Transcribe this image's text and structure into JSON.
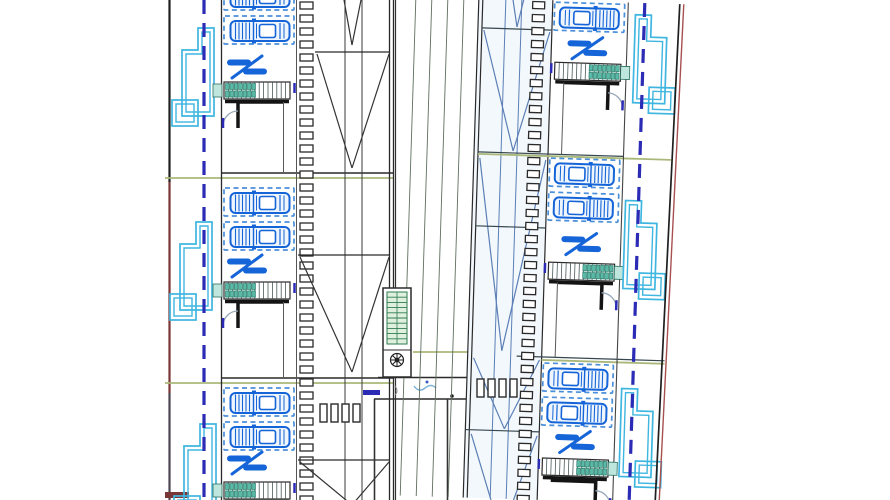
{
  "title": "Residential site plan CAD drawing",
  "colors": {
    "paper": "#ffffff",
    "car_blue": "#1565d8",
    "car_fill": "#eef5fd",
    "stall_blue": "#4a8fd9",
    "cyan": "#3fb6e0",
    "dash_blue": "#2b2bb5",
    "olive": "#a9b87a",
    "maroon": "#7a3636",
    "gray_boundary": "#4b4552",
    "black": "#1f1f1f",
    "wall_dark": "#141414",
    "line_dark": "#2a2a2a",
    "line_mid": "#555555",
    "teal": "#57b9a6",
    "teal_fill": "#bfe6dd",
    "teal_edge": "#2b6e5f",
    "road_line": "#5f6f5f",
    "steel_blue": "#5b7fb5",
    "light_blue_fill": "#f3f8fd",
    "red_line": "#a85050",
    "arc_gray": "#98a8b8",
    "shaft_green": "#2e7d4f",
    "shaft_fill": "#dff0df",
    "squiggle": "#7fb3d8"
  },
  "geometry": {
    "canvas": {
      "w": 890,
      "h": 500
    },
    "left_strip": {
      "boundary_x": 169.5,
      "boundary_segments": [
        {
          "y1": 0,
          "y2": 182,
          "color_key": "black"
        },
        {
          "y1": 182,
          "y2": 393,
          "color_key": "maroon"
        },
        {
          "y1": 393,
          "y2": 500,
          "color_key": "gray_boundary"
        }
      ],
      "bottom_mark": {
        "x": 165,
        "y": 492,
        "w": 24,
        "h": 6
      },
      "dashed_x": 204,
      "pools": [
        {
          "tx": 172,
          "ty": 28
        },
        {
          "tx": 170,
          "ty": 222
        },
        {
          "tx": 174,
          "ty": 424
        }
      ]
    },
    "dividers": {
      "olive": [
        [
          165,
          178,
          393,
          178
        ],
        [
          165,
          383,
          393,
          383
        ]
      ],
      "dark": [
        [
          221,
          173,
          393,
          173
        ],
        [
          221,
          378,
          393,
          378
        ]
      ]
    },
    "left_units": {
      "wall_x": 221.5,
      "edge_x": 296.5,
      "stall": {
        "x": 224,
        "w": 70,
        "h": 28
      },
      "car_dx": 3.5,
      "car_dy": 3,
      "gate_x": 247,
      "stair_x": 224,
      "rows": [
        {
          "stalls": [
            -18,
            16
          ],
          "gate": 67,
          "stair": 82,
          "wall": 102,
          "divider": 173
        },
        {
          "stalls": [
            188,
            222
          ],
          "gate": 266,
          "stair": 282,
          "wall": 302,
          "divider": 378
        },
        {
          "stalls": [
            388,
            422
          ],
          "gate": 463,
          "stair": 482,
          "wall": null,
          "divider": null
        }
      ]
    },
    "left_building": {
      "hatch": {
        "x": 300,
        "w": 13,
        "h": 7,
        "y0": 2,
        "step": 13,
        "count": 39
      },
      "verticals": [
        345,
        362
      ],
      "edge_x": [
        389.5,
        393.5
      ],
      "rows": [
        {
          "top": 52,
          "x1": 315,
          "apex": [
            352,
            168
          ],
          "pre": [
            [
              344,
              0,
              352,
              45
            ],
            [
              361,
              0,
              352,
              45
            ]
          ]
        },
        {
          "top": 255,
          "x1": 298,
          "apex": [
            352,
            372
          ]
        },
        {
          "top": 460,
          "x1": 298,
          "apex": [
            352,
            505
          ]
        }
      ],
      "vents": {
        "y": 404,
        "h": 18,
        "w": 7,
        "xs": [
          320,
          331,
          342,
          353
        ]
      }
    },
    "road": {
      "left_x": 395.5,
      "olive_line": [
        413,
        352,
        473,
        352
      ],
      "walkway": [
        [
          378,
          377.5,
          478,
          377.5
        ],
        [
          374,
          399,
          478,
          399
        ]
      ],
      "lower_walls": [
        [
          374.5,
          399,
          374.5,
          500
        ],
        [
          447.5,
          399,
          447.5,
          500
        ]
      ],
      "blue_dash": {
        "x": 363,
        "y": 390,
        "w": 17,
        "h": 5
      },
      "crosswalk": {
        "y": 379,
        "h": 18,
        "w": 7,
        "xs": [
          477,
          488,
          499,
          510
        ]
      },
      "shaft": {
        "x": 383,
        "y": 288,
        "w": 28,
        "h": 89
      }
    },
    "right_group": {
      "angle": 1.8,
      "cx": 545,
      "cy": 250,
      "road_lines": [
        408,
        424,
        440,
        456
      ],
      "building": {
        "x1": 471,
        "x2": 475,
        "x3": 545,
        "hatch": {
          "x": 525,
          "w": 12,
          "h": 7,
          "y0": 2,
          "step": 13,
          "count": 39
        },
        "verticals": [
          498,
          514
        ],
        "dividers": [
          [
            475,
            30,
            545,
            30
          ],
          [
            475,
            154,
            620,
            154
          ],
          [
            475,
            228,
            545,
            228
          ],
          [
            520,
            357,
            668,
            357
          ],
          [
            471,
            432,
            545,
            432
          ]
        ],
        "olive": [
          [
            475,
            156,
            668,
            156
          ],
          [
            545,
            360,
            668,
            360
          ]
        ],
        "diags": [
          [
            477,
            32,
            510,
            152
          ],
          [
            543,
            32,
            510,
            152
          ],
          [
            477,
            160,
            505,
            352
          ],
          [
            543,
            160,
            505,
            352
          ],
          [
            477,
            360,
            510,
            430
          ],
          [
            543,
            360,
            510,
            430
          ],
          [
            477,
            436,
            500,
            505
          ],
          [
            543,
            436,
            520,
            505
          ],
          [
            505,
            0,
            510,
            28
          ],
          [
            516,
            0,
            510,
            28
          ]
        ]
      },
      "units": {
        "wall_x": 620.5,
        "edge_x": 545.5,
        "stall": {
          "x": 547,
          "w": 70,
          "h": 28
        },
        "gate_x": 581,
        "rows": [
          {
            "stalls": [
              -32,
              2
            ],
            "gate": 47,
            "stair": 62,
            "wall": 82,
            "divider": 154
          },
          {
            "stalls": [
              158,
              192
            ],
            "gate": 243,
            "stair": 262,
            "wall": 282,
            "divider": 357
          },
          {
            "stalls": [
              363,
              397
            ],
            "gate": 441,
            "stair": 458,
            "wall": 480,
            "divider": null
          }
        ]
      },
      "pools": [
        {
          "tx": 670,
          "ty": 12
        },
        {
          "tx": 666,
          "ty": 198
        },
        {
          "tx": 668,
          "ty": 386
        }
      ],
      "dashed_x": 637,
      "boundary_black": [
        672,
        0,
        663,
        500
      ],
      "boundary_red": [
        676,
        0,
        667,
        500
      ]
    }
  }
}
